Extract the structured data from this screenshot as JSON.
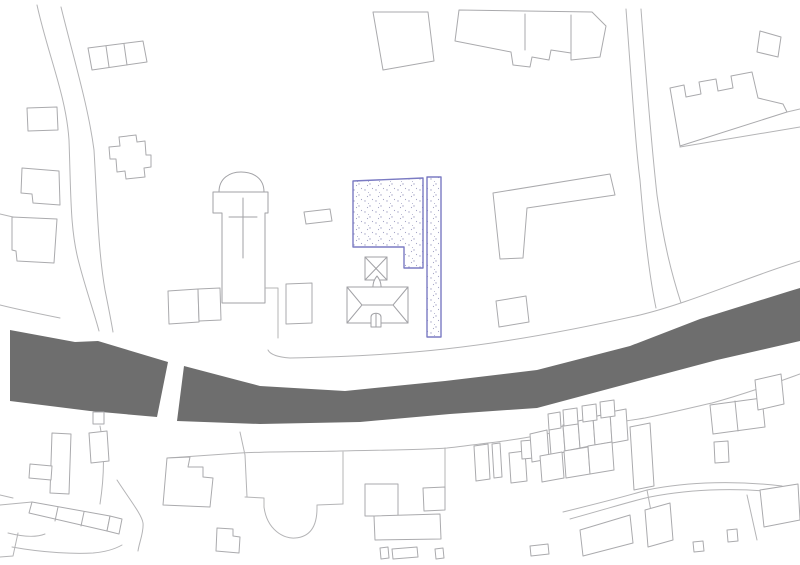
{
  "meta": {
    "kind": "architectural site plan (cadastral map, no visible text)",
    "canvas": {
      "width": 800,
      "height": 565
    }
  },
  "colors": {
    "background": "#ffffff",
    "line": "#b4b4b6",
    "building_line": "#aaaaad",
    "church_line": "#a2a2a6",
    "river": "#6e6e6e",
    "parcel_stroke": "#7b7bc3",
    "parcel_fill": "#fdfdfe",
    "stipple_dot": "#a6a6c6"
  },
  "features": {
    "river": "dark waterway band crossing the plan with bridge gap at left",
    "parcel": "blue-outlined stippled site parcel in centre",
    "church": "church plan with cross symbol and apse",
    "tower": "square tower with pyramidal (X) roof",
    "hall": "hip-roofed hall building with ridge",
    "roads": "curving road and bank boundary lines",
    "buildings": "surrounding building and plot outlines"
  }
}
